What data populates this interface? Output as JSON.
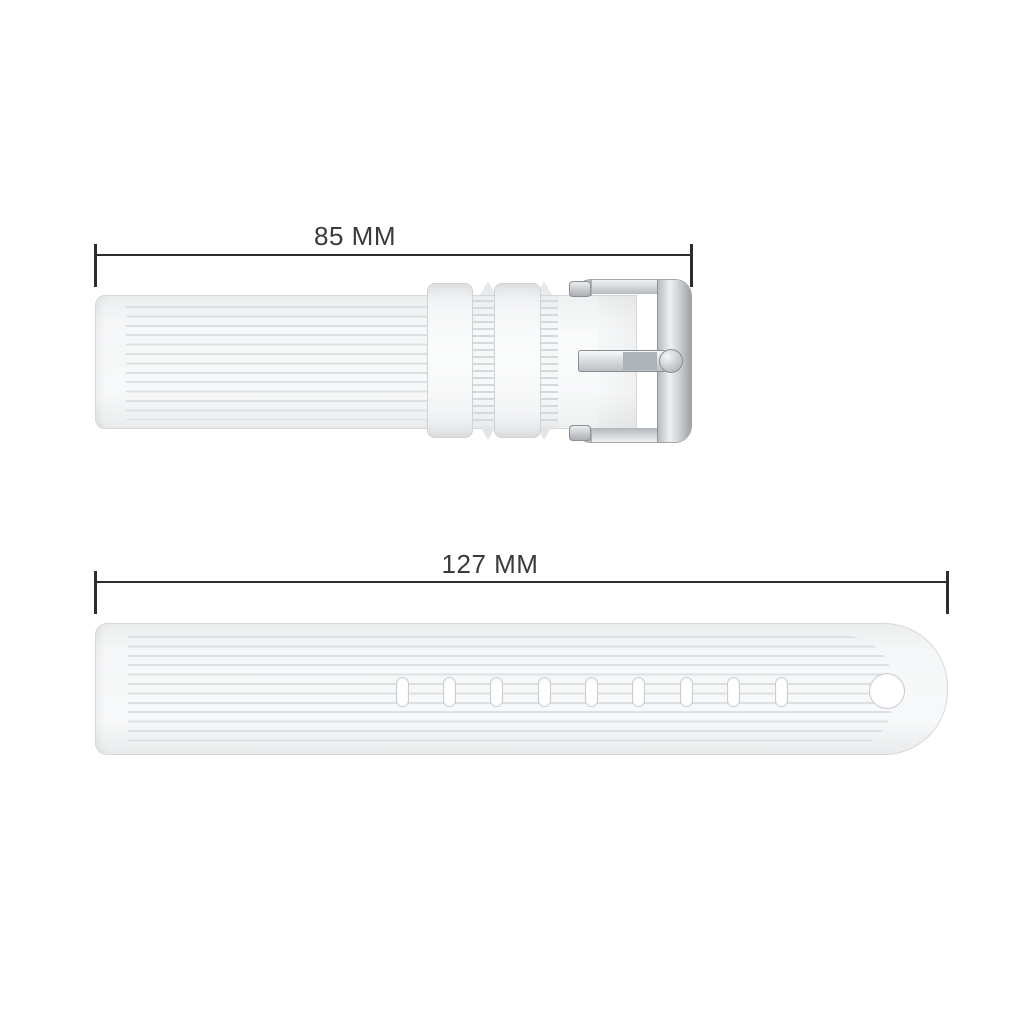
{
  "image": {
    "kind": "watch-strap-dimension-diagram",
    "background_color": "#ffffff"
  },
  "measurements": {
    "short_strap": {
      "label": "85 MM",
      "value_mm": 85
    },
    "long_strap": {
      "label": "127 MM",
      "value_mm": 127
    }
  },
  "short_strap": {
    "description": "buckle-side silicone strap, ribbed texture",
    "keeper_count": 2,
    "buckle_style": "silver pin buckle"
  },
  "long_strap": {
    "description": "holes-side silicone strap, ribbed texture, rounded tip",
    "slot_count": 9,
    "round_hole_count": 1
  },
  "colors": {
    "dimension_line": "#2d2d2d",
    "label_text": "#3a3a3a",
    "strap_fill": "#f4f5f6",
    "strap_border": "#d5d7d9",
    "rib_line": "#dde0e3",
    "buckle_silver": "#c3c7ca",
    "prong_shade": "#adb3b7"
  }
}
